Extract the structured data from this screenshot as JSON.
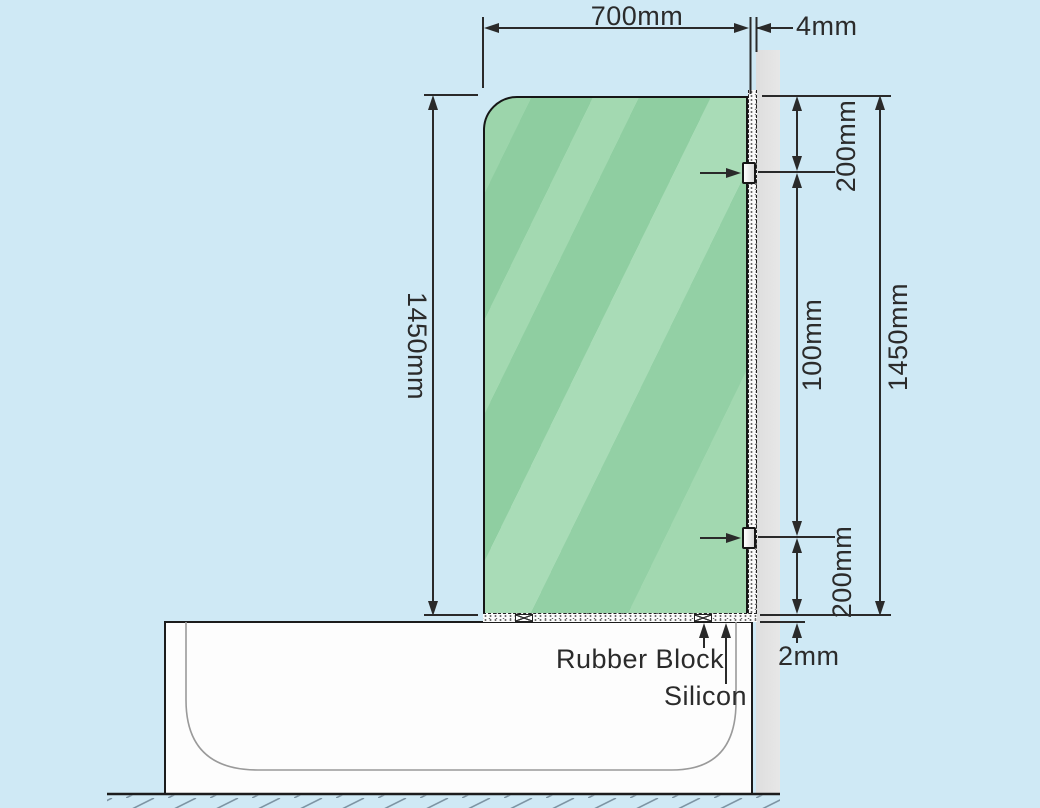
{
  "scene": {
    "type": "bath-shower-screen-installation-diagram",
    "dimensions": {
      "glass_width": "700mm",
      "wall_gap": "4mm",
      "glass_height_left": "1450mm",
      "glass_height_right": "1450mm",
      "bracket_top_offset": "200mm",
      "bracket_spacing": "100mm",
      "bracket_bottom_offset": "200mm",
      "base_silicon_gap": "2mm"
    },
    "annotations": {
      "rubber_block": "Rubber Block",
      "silicon": "Silicon"
    },
    "colors": {
      "background": "#cfe9f5",
      "glass_base": "#93cfa4",
      "glass_highlight": "#a9dcb7",
      "wall": "#e2e2e2",
      "tub": "#fdfdfd",
      "ink": "#2b2b2b"
    }
  }
}
